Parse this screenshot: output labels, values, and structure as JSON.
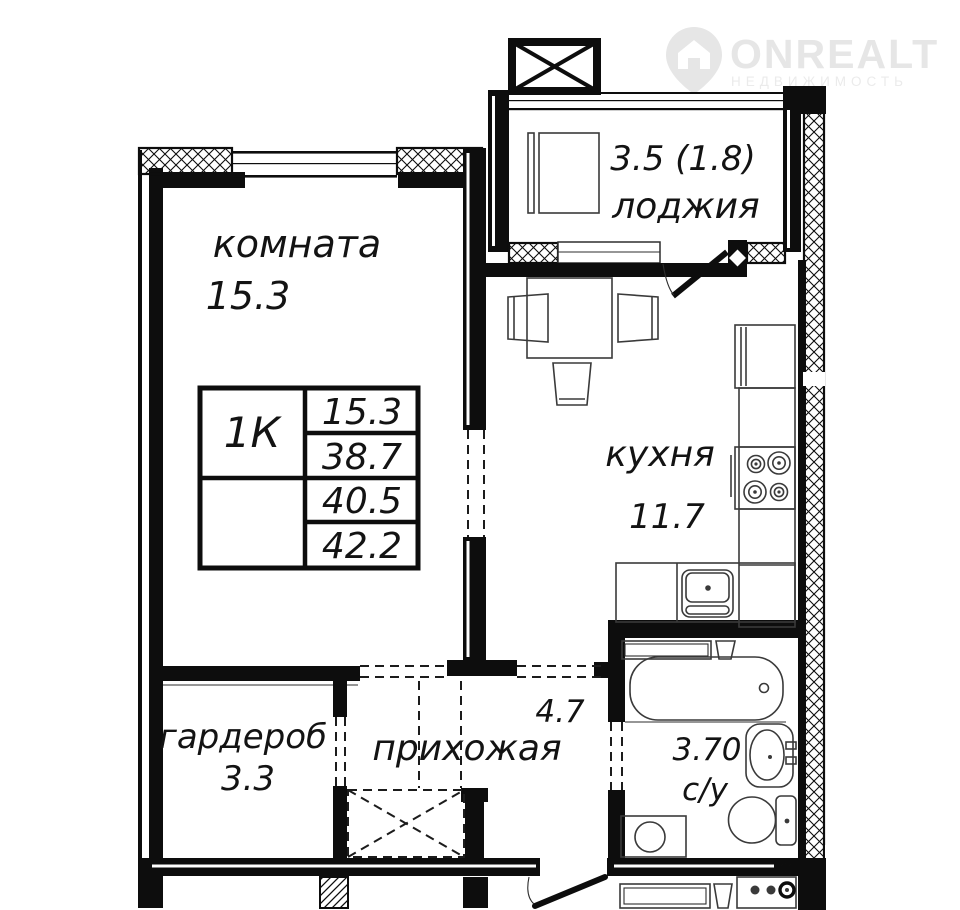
{
  "brand": {
    "name": "ONREALT",
    "subtitle": "НЕДВИЖИМОСТЬ",
    "icon": "location-pin-house",
    "watermark_color": "#e6e6e6"
  },
  "plan": {
    "line_color": "#0d0d0d",
    "unit_table": {
      "type": "1К",
      "rows": [
        "15.3",
        "38.7",
        "40.5",
        "42.2"
      ]
    },
    "rooms": {
      "living_room": {
        "label": "комната",
        "area": "15.3"
      },
      "loggia": {
        "label": "лоджия",
        "area": "3.5 (1.8)"
      },
      "kitchen": {
        "label": "кухня",
        "area": "11.7"
      },
      "hallway": {
        "label": "прихожая",
        "area": "4.7"
      },
      "wardrobe": {
        "label": "гардероб",
        "area": "3.3"
      },
      "bathroom": {
        "label": "с/у",
        "area": "3.70"
      }
    }
  }
}
